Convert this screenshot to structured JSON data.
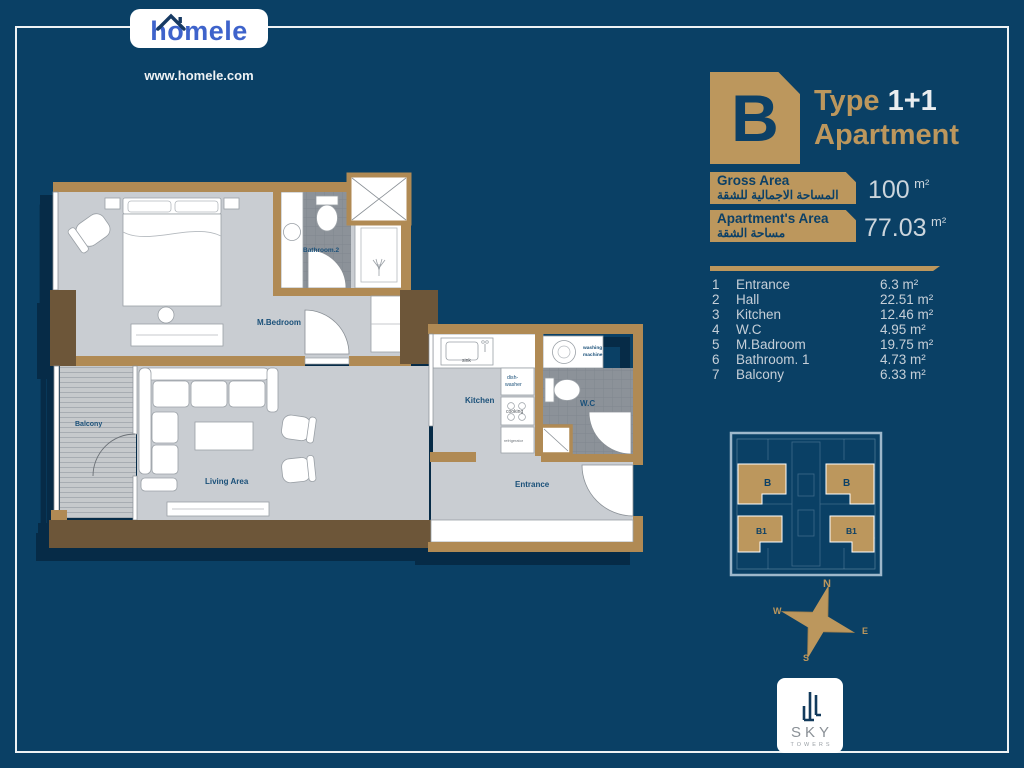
{
  "colors": {
    "background": "#0a4065",
    "frame": "#eef2f4",
    "gold": "#bc975d",
    "navy_on_gold": "#0c4066",
    "logo_blue": "#3e63cb",
    "wall_tan": "#b08a54",
    "wall_dark": "#6d5639",
    "floor_gray": "#c9cdd2",
    "tile_gray": "#8c9299",
    "plan_label_navy": "#1a5079",
    "list_text": "#c6cfd8",
    "value_text": "#ccd5dc"
  },
  "logo": {
    "brand": "homele",
    "website": "www.homele.com"
  },
  "header": {
    "type_letter": "B",
    "type_word": "Type",
    "type_value": "1+1",
    "subtitle": "Apartment"
  },
  "areas": [
    {
      "label_en": "Gross Area",
      "label_ar": "المساحة الاجمالية للشقة",
      "value": "100",
      "unit": "m²"
    },
    {
      "label_en": "Apartment's Area",
      "label_ar": "مساحة الشقة",
      "value": "77.03",
      "unit": "m²"
    }
  ],
  "rooms": [
    {
      "no": "1",
      "name": "Entrance",
      "area": "6.3 m²"
    },
    {
      "no": "2",
      "name": "Hall",
      "area": "22.51 m²"
    },
    {
      "no": "3",
      "name": "Kitchen",
      "area": "12.46 m²"
    },
    {
      "no": "4",
      "name": "W.C",
      "area": "4.95 m²"
    },
    {
      "no": "5",
      "name": "M.Badroom",
      "area": "19.75 m²"
    },
    {
      "no": "6",
      "name": "Bathroom. 1",
      "area": "4.73 m²"
    },
    {
      "no": "7",
      "name": "Balcony",
      "area": "6.33 m²"
    }
  ],
  "floorplan": {
    "labels": {
      "bedroom": "M.Bedroom",
      "bathroom2": "Bathroom.2",
      "balcony": "Balcony",
      "living": "Living Area",
      "kitchen": "Kitchen",
      "wc": "W.C",
      "entrance": "Entrance",
      "sink": "sink",
      "dishwasher_1": "dish-",
      "dishwasher_2": "washer",
      "cooking": "cooking",
      "refrigerator": "refrigerator",
      "washing_1": "washing",
      "washing_2": "machine"
    }
  },
  "minimap": {
    "unit_top": "B",
    "unit_bottom": "B1"
  },
  "compass": {
    "n": "N",
    "e": "E",
    "s": "S",
    "w": "W"
  },
  "developer": {
    "name": "SKY",
    "sub": "TOWERS"
  }
}
